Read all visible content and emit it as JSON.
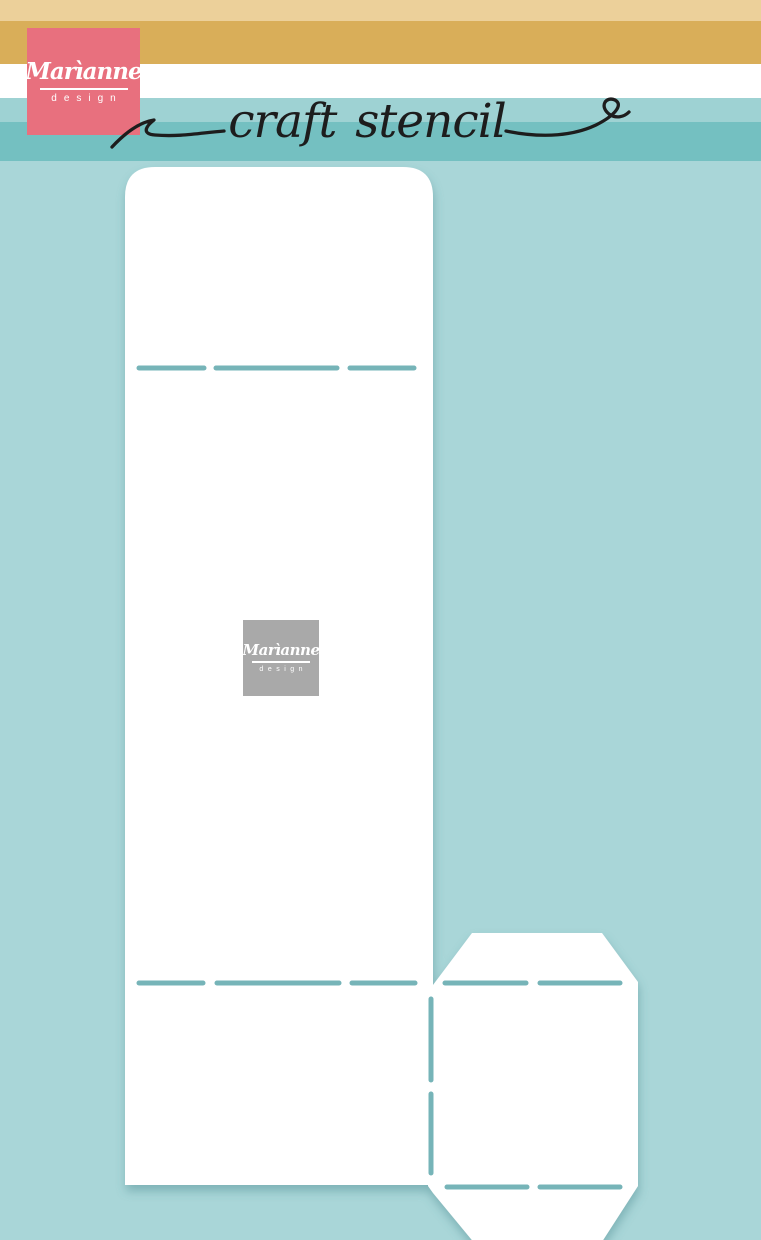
{
  "background": {
    "color": "#a9d6d8"
  },
  "header": {
    "stripes": [
      {
        "name": "tan-light",
        "color": "#ecd09a"
      },
      {
        "name": "gold",
        "color": "#d9ae59"
      },
      {
        "name": "white",
        "color": "#ffffff"
      },
      {
        "name": "teal-light",
        "color": "#9ed2d3"
      },
      {
        "name": "teal-medium",
        "color": "#74c0c1"
      }
    ],
    "brand_logo": {
      "name": "Marìanne",
      "sub": "design",
      "background": "#e8707e",
      "text_color": "#ffffff"
    },
    "title": {
      "text": "craft stencil",
      "ink": "#1d1d1d"
    }
  },
  "stencil": {
    "fill": "#ffffff",
    "shadow_color": "#45858c",
    "watermark_logo": {
      "name": "Marìanne",
      "sub": "design",
      "background": "#a9a9a9",
      "text_color": "#ffffff"
    },
    "fold_lines": {
      "color": "#76b4b8",
      "thickness": 5,
      "horizontal": [
        {
          "y": 368,
          "segments": [
            [
              139,
              204
            ],
            [
              216,
              337
            ],
            [
              350,
              414
            ]
          ]
        },
        {
          "y": 983,
          "segments": [
            [
              139,
              203
            ],
            [
              217,
              339
            ],
            [
              352,
              415
            ],
            [
              445,
              526
            ],
            [
              540,
              620
            ]
          ]
        },
        {
          "y": 1187,
          "segments": [
            [
              447,
              527
            ],
            [
              540,
              620
            ]
          ]
        }
      ],
      "vertical": [
        {
          "x": 431,
          "segments": [
            [
              999,
              1080
            ],
            [
              1094,
              1173
            ]
          ]
        }
      ]
    }
  }
}
